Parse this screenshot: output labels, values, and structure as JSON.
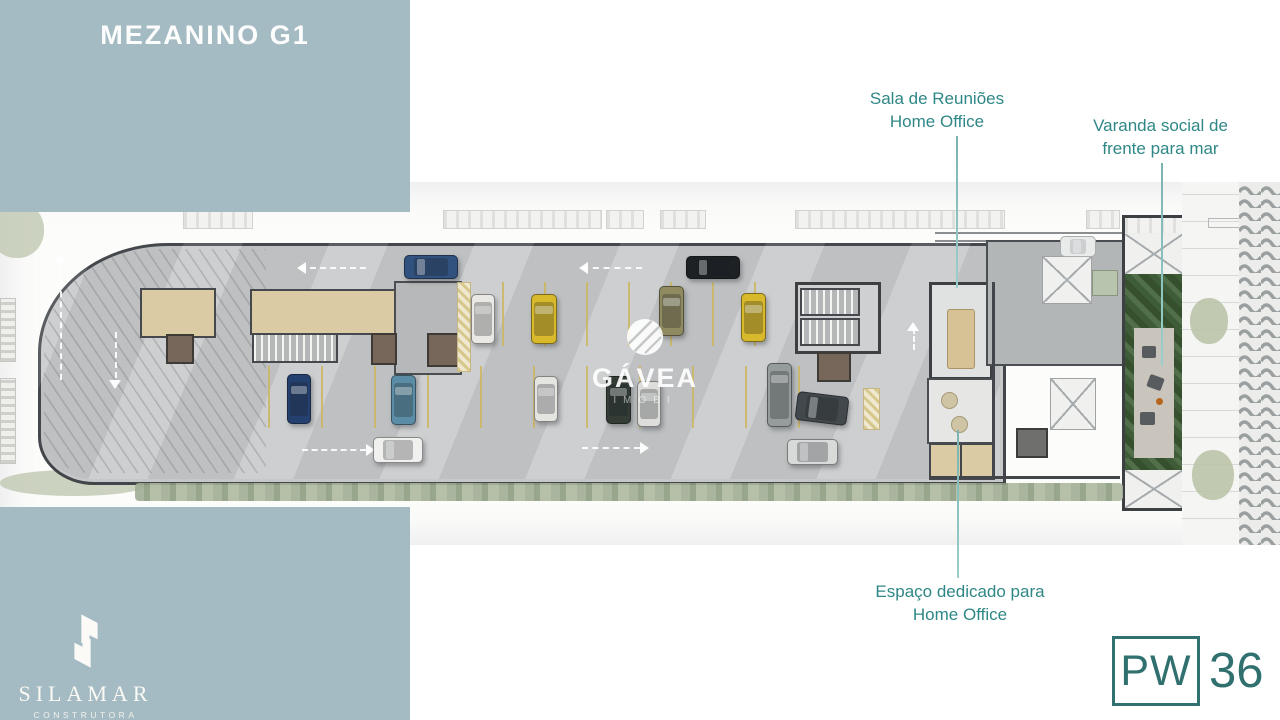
{
  "header": {
    "title": "MEZANINO G1"
  },
  "annotations": {
    "meeting_room": {
      "line1": "Sala de Reuniões",
      "line2": "Home Office"
    },
    "balcony": {
      "line1": "Varanda social de",
      "line2": "frente para mar"
    },
    "home_office": {
      "line1": "Espaço dedicado para",
      "line2": "Home Office"
    }
  },
  "watermark": {
    "name": "GÁVEA",
    "sub": "IMOBI"
  },
  "builder": {
    "name": "SILAMAR",
    "tagline": "CONSTRUTORA"
  },
  "project": {
    "initials": "PW",
    "number": "36"
  },
  "colors": {
    "panel_blue": "#a4bbc3",
    "annotation_teal": "#2f8786",
    "logo_teal": "#30706f",
    "slab_gray": "#c6c8c9",
    "parking_yellow": "#cbb660"
  }
}
